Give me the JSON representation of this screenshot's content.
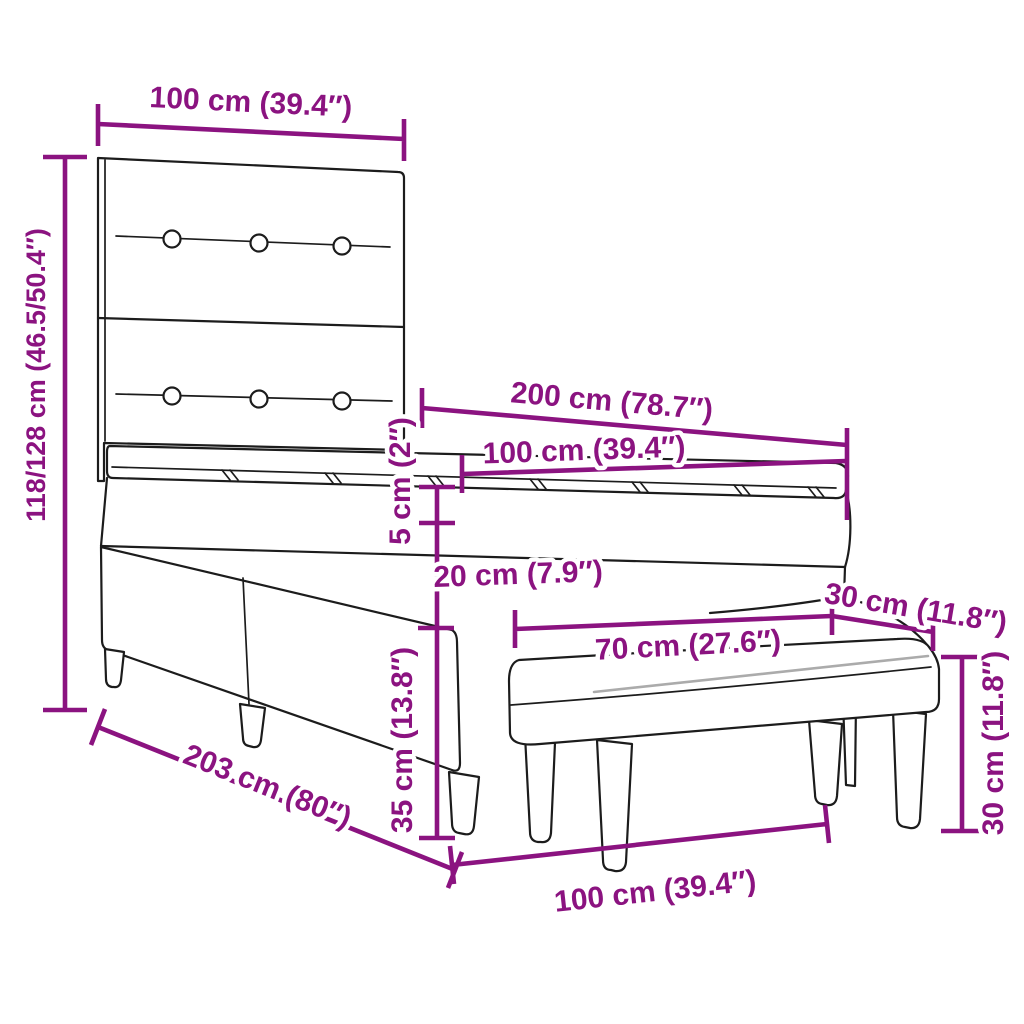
{
  "diagram": {
    "subject": "box spring bed with headboard, mattress topper and upholstered bench",
    "colors": {
      "dimension_annotation": "#8B1380",
      "line_art_outline": "#1C1C1C",
      "cushion_shading": "#ABABAB",
      "background": "#FFFFFF"
    },
    "labels": {
      "headboard_width": "100 cm (39.4″)",
      "overall_height": "118/128 cm (46.5/50.4″)",
      "mattress_length": "200 cm (78.7″)",
      "mattress_width": "100 cm (39.4″)",
      "topper_thickness": "5 cm (2″)",
      "mattress_thickness": "20 cm (7.9″)",
      "base_height": "35 cm (13.8″)",
      "bench_depth": "30 cm (11.8″)",
      "bench_seat_width": "70 cm (27.6″)",
      "bench_height": "30 cm (11.8″)",
      "bed_total_length": "203 cm (80″)",
      "bench_total_width": "100 cm (39.4″)"
    }
  }
}
